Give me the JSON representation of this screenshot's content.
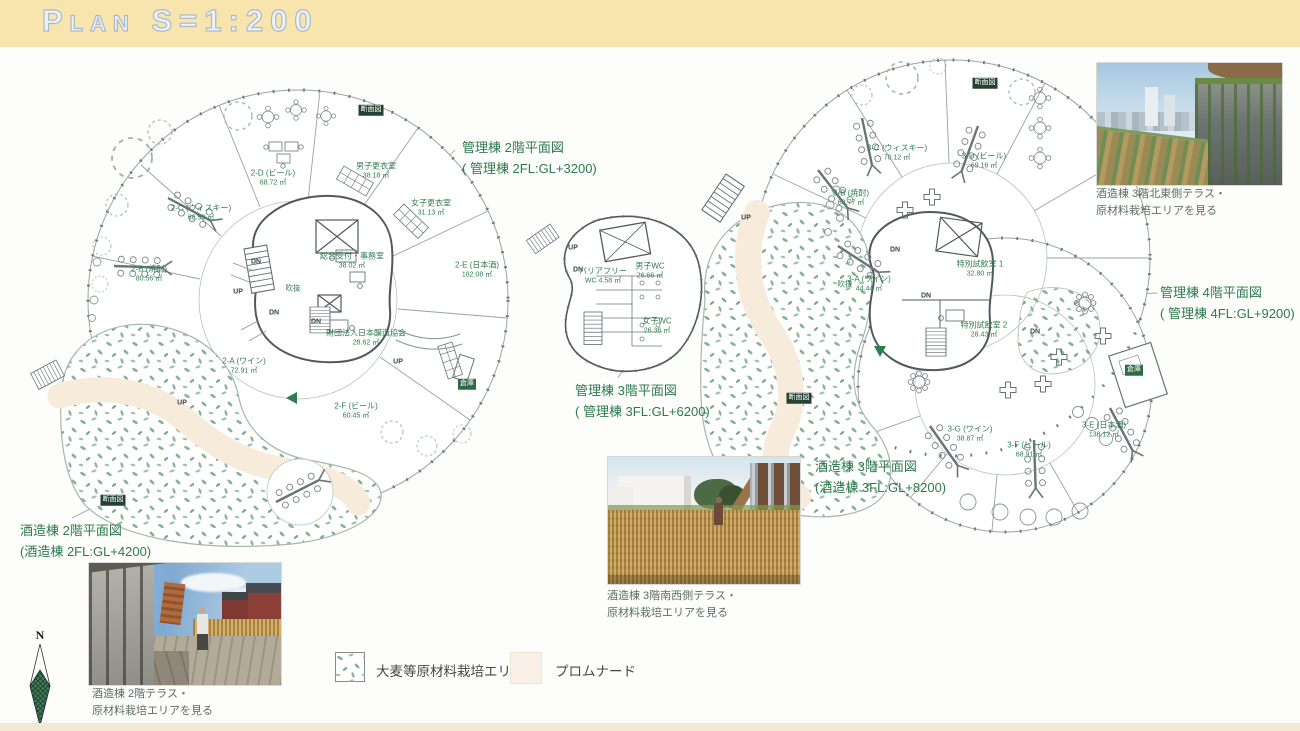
{
  "header": {
    "title": "Plan  S=1:200"
  },
  "colors": {
    "header_bg": "#f8e5ae",
    "annotation_green": "#2d7a4e",
    "planting_green": "#86b294",
    "promenade_cream": "#f9efe6"
  },
  "annotations": {
    "kanri2": {
      "line1": "管理棟 2階平面図",
      "line2": "( 管理棟 2FL:GL+3200)"
    },
    "kanri3": {
      "line1": "管理棟 3階平面図",
      "line2": "( 管理棟 3FL:GL+6200)"
    },
    "kanri4": {
      "line1": "管理棟 4階平面図",
      "line2": "( 管理棟 4FL:GL+9200)"
    },
    "shuzo3": {
      "line1": "酒造棟 3階平面図",
      "line2": "(酒造棟 3FL:GL+8200)"
    },
    "shuzo2": {
      "line1": "酒造棟 2階平面図",
      "line2": "(酒造棟 2FL:GL+4200)"
    }
  },
  "photos": {
    "ne_terrace": {
      "caption1": "酒造棟 3階北東側テラス・",
      "caption2": "原材料栽培エリアを見る"
    },
    "sw_terrace": {
      "caption1": "酒造棟 3階南西側テラス・",
      "caption2": "原材料栽培エリアを見る"
    },
    "terrace_2f": {
      "caption1": "酒造棟 2階テラス・",
      "caption2": "原材料栽培エリアを見る"
    }
  },
  "legend": {
    "planting_label": "大麦等原材料栽培エリア",
    "promenade_label": "プロムナード"
  },
  "north_label": "N",
  "rooms_left": [
    {
      "name": "2-D (ビール)",
      "area": "68.72 ㎡",
      "x": 273,
      "y": 178
    },
    {
      "name": "男子更衣室",
      "area": "38.18 ㎡",
      "x": 376,
      "y": 171
    },
    {
      "name": "女子更衣室",
      "area": "31.13 ㎡",
      "x": 431,
      "y": 208
    },
    {
      "name": "2-C (ウィスキー)",
      "area": "68.59 ㎡",
      "x": 201,
      "y": 213
    },
    {
      "name": "2-B (焼酎)",
      "area": "80.56 ㎡",
      "x": 149,
      "y": 274
    },
    {
      "name": "総合受付・事務室",
      "area": "38.02 ㎡",
      "x": 352,
      "y": 261
    },
    {
      "name": "2-E (日本酒)",
      "area": "182.08 ㎡",
      "x": 477,
      "y": 270
    },
    {
      "name": "財団法人日本醸造協会",
      "area": "28.62 ㎡",
      "x": 366,
      "y": 338
    },
    {
      "name": "2-A (ワイン)",
      "area": "72.91 ㎡",
      "x": 244,
      "y": 366
    },
    {
      "name": "2-F (ビール)",
      "area": "60.45 ㎡",
      "x": 356,
      "y": 411
    }
  ],
  "rooms_middle": [
    {
      "name": "男子WC",
      "area": "26.66 ㎡",
      "x": 650,
      "y": 271
    },
    {
      "name": "バリアフリー",
      "area": "WC 4.58 ㎡",
      "x": 603,
      "y": 276
    },
    {
      "name": "女子WC",
      "area": "26.36 ㎡",
      "x": 657,
      "y": 326
    }
  ],
  "rooms_right": [
    {
      "name": "3-C (ウィスキー)",
      "area": "70.12 ㎡",
      "x": 897,
      "y": 153
    },
    {
      "name": "3-D (ビール)",
      "area": "69.16 ㎡",
      "x": 984,
      "y": 161
    },
    {
      "name": "3-B (焼酎)",
      "area": "63.77 ㎡",
      "x": 851,
      "y": 198
    },
    {
      "name": "3-A (ワイン)",
      "area": "44.44 ㎡",
      "x": 869,
      "y": 284
    },
    {
      "name": "特別試飲室 1",
      "area": "32.80 ㎡",
      "x": 980,
      "y": 269
    },
    {
      "name": "特別試飲室 2",
      "area": "28.43 ㎡",
      "x": 984,
      "y": 330
    },
    {
      "name": "3-G (ワイン)",
      "area": "38.87 ㎡",
      "x": 970,
      "y": 434
    },
    {
      "name": "3-F (ビール)",
      "area": "68.91 ㎡",
      "x": 1029,
      "y": 450
    },
    {
      "name": "3-E (日本酒)",
      "area": "138.12 ㎡",
      "x": 1104,
      "y": 430
    }
  ],
  "tags": [
    {
      "text": "DN",
      "type": "stair",
      "x": 256,
      "y": 262
    },
    {
      "text": "UP",
      "type": "stair",
      "x": 238,
      "y": 292
    },
    {
      "text": "DN",
      "type": "stair",
      "x": 274,
      "y": 313
    },
    {
      "text": "DN",
      "type": "stair",
      "x": 316,
      "y": 322
    },
    {
      "text": "UP",
      "type": "stair",
      "x": 398,
      "y": 362
    },
    {
      "text": "UP",
      "type": "stair",
      "x": 182,
      "y": 403
    },
    {
      "text": "吹抜",
      "type": "void",
      "x": 293,
      "y": 288
    },
    {
      "text": "断面図",
      "type": "section",
      "x": 371,
      "y": 110
    },
    {
      "text": "断面図",
      "type": "section",
      "x": 113,
      "y": 500
    },
    {
      "text": "倉庫",
      "type": "store",
      "x": 467,
      "y": 384
    },
    {
      "text": "UP",
      "type": "stair",
      "x": 573,
      "y": 248
    },
    {
      "text": "DN",
      "type": "stair",
      "x": 578,
      "y": 270
    },
    {
      "text": "UP",
      "type": "stair",
      "x": 746,
      "y": 218
    },
    {
      "text": "DN",
      "type": "stair",
      "x": 895,
      "y": 250
    },
    {
      "text": "DN",
      "type": "stair",
      "x": 926,
      "y": 296
    },
    {
      "text": "DN",
      "type": "stair",
      "x": 1035,
      "y": 332
    },
    {
      "text": "吹抜",
      "type": "void",
      "x": 845,
      "y": 284
    },
    {
      "text": "断面図",
      "type": "section",
      "x": 985,
      "y": 83
    },
    {
      "text": "断面図",
      "type": "section",
      "x": 799,
      "y": 398
    },
    {
      "text": "倉庫",
      "type": "store",
      "x": 1134,
      "y": 370
    }
  ]
}
